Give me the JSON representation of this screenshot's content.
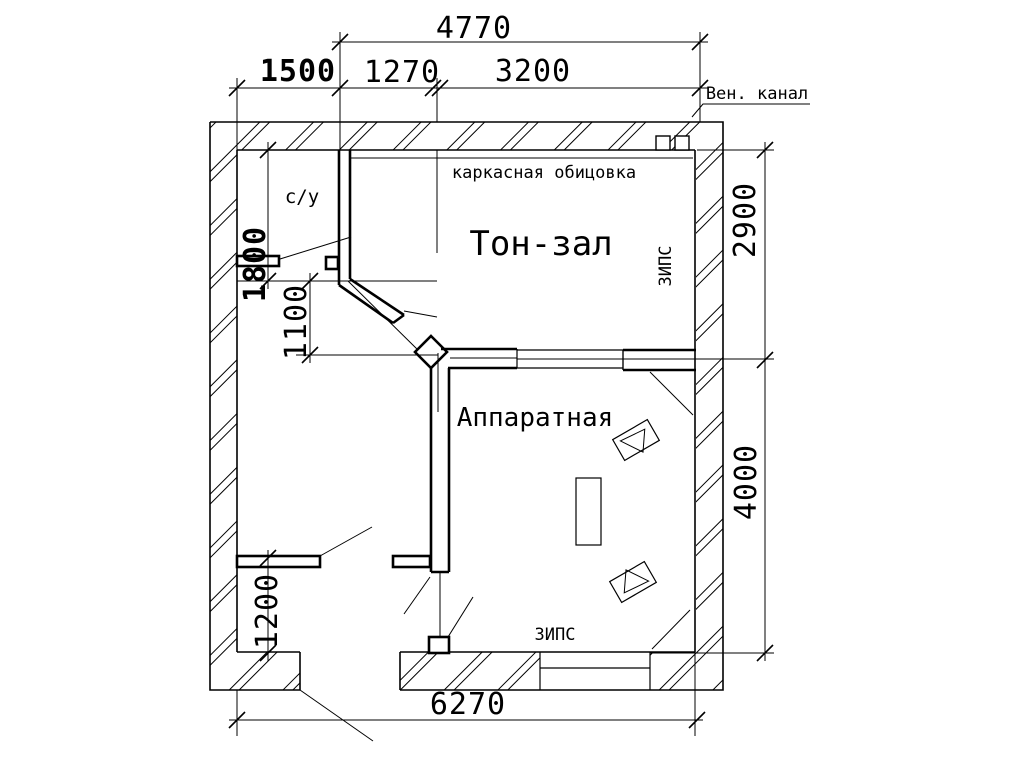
{
  "drawing": {
    "kind": "studio floor plan",
    "labels": {
      "vent_channel": "Вен. канал",
      "cladding": "каркасная обицовка",
      "tone_hall": "Тон-зал",
      "control_room": "Аппаратная",
      "bathroom": "с/у",
      "zips_right": "ЗИПС",
      "zips_bottom": "ЗИПС"
    },
    "dimensions": {
      "top_total": "4770",
      "top_left": "1500",
      "top_mid": "1270",
      "top_right": "3200",
      "right_upper": "2900",
      "right_lower": "4000",
      "left_upper": "1800",
      "left_mid": "1100",
      "left_lower": "1200",
      "bottom_total": "6270"
    },
    "colors": {
      "line": "#000000",
      "background": "#ffffff"
    }
  }
}
